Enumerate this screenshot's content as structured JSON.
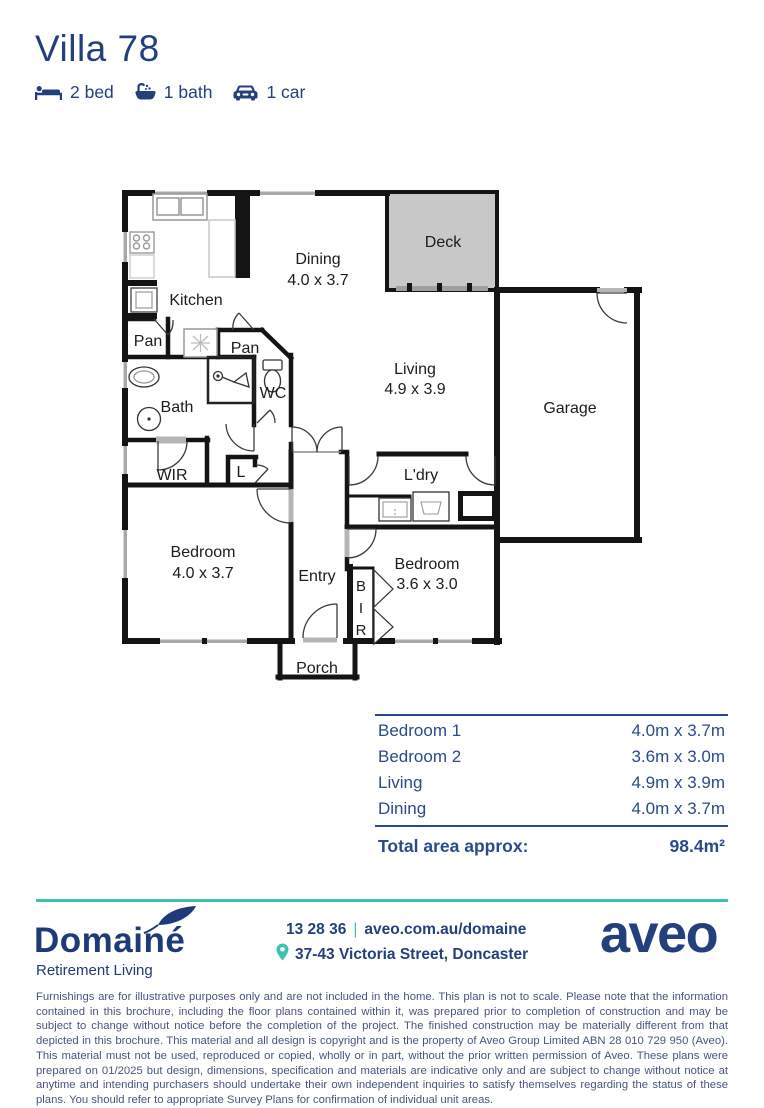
{
  "header": {
    "title": "Villa 78",
    "features": [
      {
        "icon": "bed-icon",
        "label": "2 bed"
      },
      {
        "icon": "bath-icon",
        "label": "1 bath"
      },
      {
        "icon": "car-icon",
        "label": "1 car"
      }
    ]
  },
  "floorplan": {
    "deck": "Deck",
    "dining_name": "Dining",
    "dining_dim": "4.0 x 3.7",
    "kitchen": "Kitchen",
    "pan1": "Pan",
    "pan2": "Pan",
    "living_name": "Living",
    "living_dim": "4.9 x 3.9",
    "garage": "Garage",
    "bath": "Bath",
    "wc": "WC",
    "wir": "WIR",
    "linen": "L",
    "laundry": "L'dry",
    "bed1_name": "Bedroom",
    "bed1_dim": "4.0 x 3.7",
    "entry": "Entry",
    "bed2_name": "Bedroom",
    "bed2_dim": "3.6 x 3.0",
    "bir_letters": [
      "B",
      "I",
      "R"
    ],
    "porch": "Porch"
  },
  "dimensions_table": {
    "rows": [
      {
        "room": "Bedroom 1",
        "size": "4.0m x 3.7m"
      },
      {
        "room": "Bedroom 2",
        "size": "3.6m x 3.0m"
      },
      {
        "room": "Living",
        "size": "4.9m x 3.9m"
      },
      {
        "room": "Dining",
        "size": "4.0m x 3.7m"
      }
    ],
    "total_label": "Total area approx:",
    "total_value": "98.4m²"
  },
  "footer": {
    "brand": {
      "name": "Domainé",
      "tagline": "Retirement Living"
    },
    "contact": {
      "phone": "13 28 36",
      "separator": "|",
      "website": "aveo.com.au/domaine",
      "address": "37-43 Victoria Street, Doncaster"
    },
    "logo_text": "aveo"
  },
  "colors": {
    "navy": "#24407c",
    "teal": "#3fc1b0",
    "deck_fill": "#c8c8c8"
  },
  "disclaimer": "Furnishings are for illustrative purposes only and are not included in the home. This plan is not to scale. Please note that the information contained in this brochure, including the floor plans contained within it, was prepared prior to completion of construction and may be subject to change without notice before the completion of the project. The finished construction may be materially different from that depicted in this brochure. This material and all design is copyright and is the property of Aveo Group Limited ABN 28 010 729 950 (Aveo). This material must not be used, reproduced or copied, wholly or in part, without the prior written permission of Aveo. These plans were prepared on 01/2025 but design, dimensions, specification and materials are indicative only and are subject to change without notice at anytime and intending purchasers should undertake their own independent inquiries to satisfy themselves regarding the status of these plans. You should refer to appropriate Survey Plans for confirmation of individual unit areas."
}
